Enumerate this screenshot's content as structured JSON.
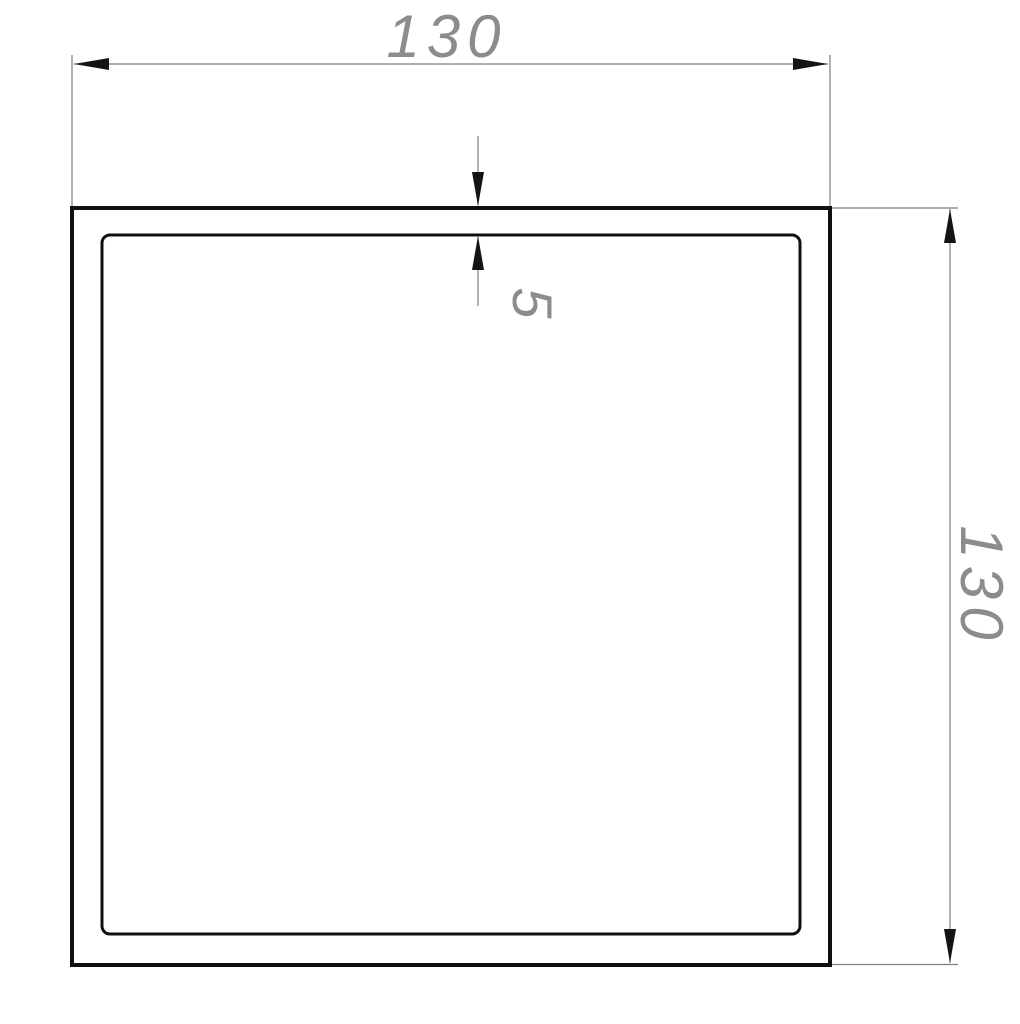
{
  "drawing": {
    "type": "square-tube-cross-section",
    "dimensions": {
      "outer_width": {
        "label": "130"
      },
      "outer_height": {
        "label": "130"
      },
      "wall_thickness": {
        "label": "5"
      }
    },
    "colors": {
      "profile_stroke": "#101010",
      "dimension_lines": "#7f7f7f",
      "dimension_text": "#8c8c8c",
      "arrowheads": "#141414",
      "background": "#ffffff"
    }
  }
}
